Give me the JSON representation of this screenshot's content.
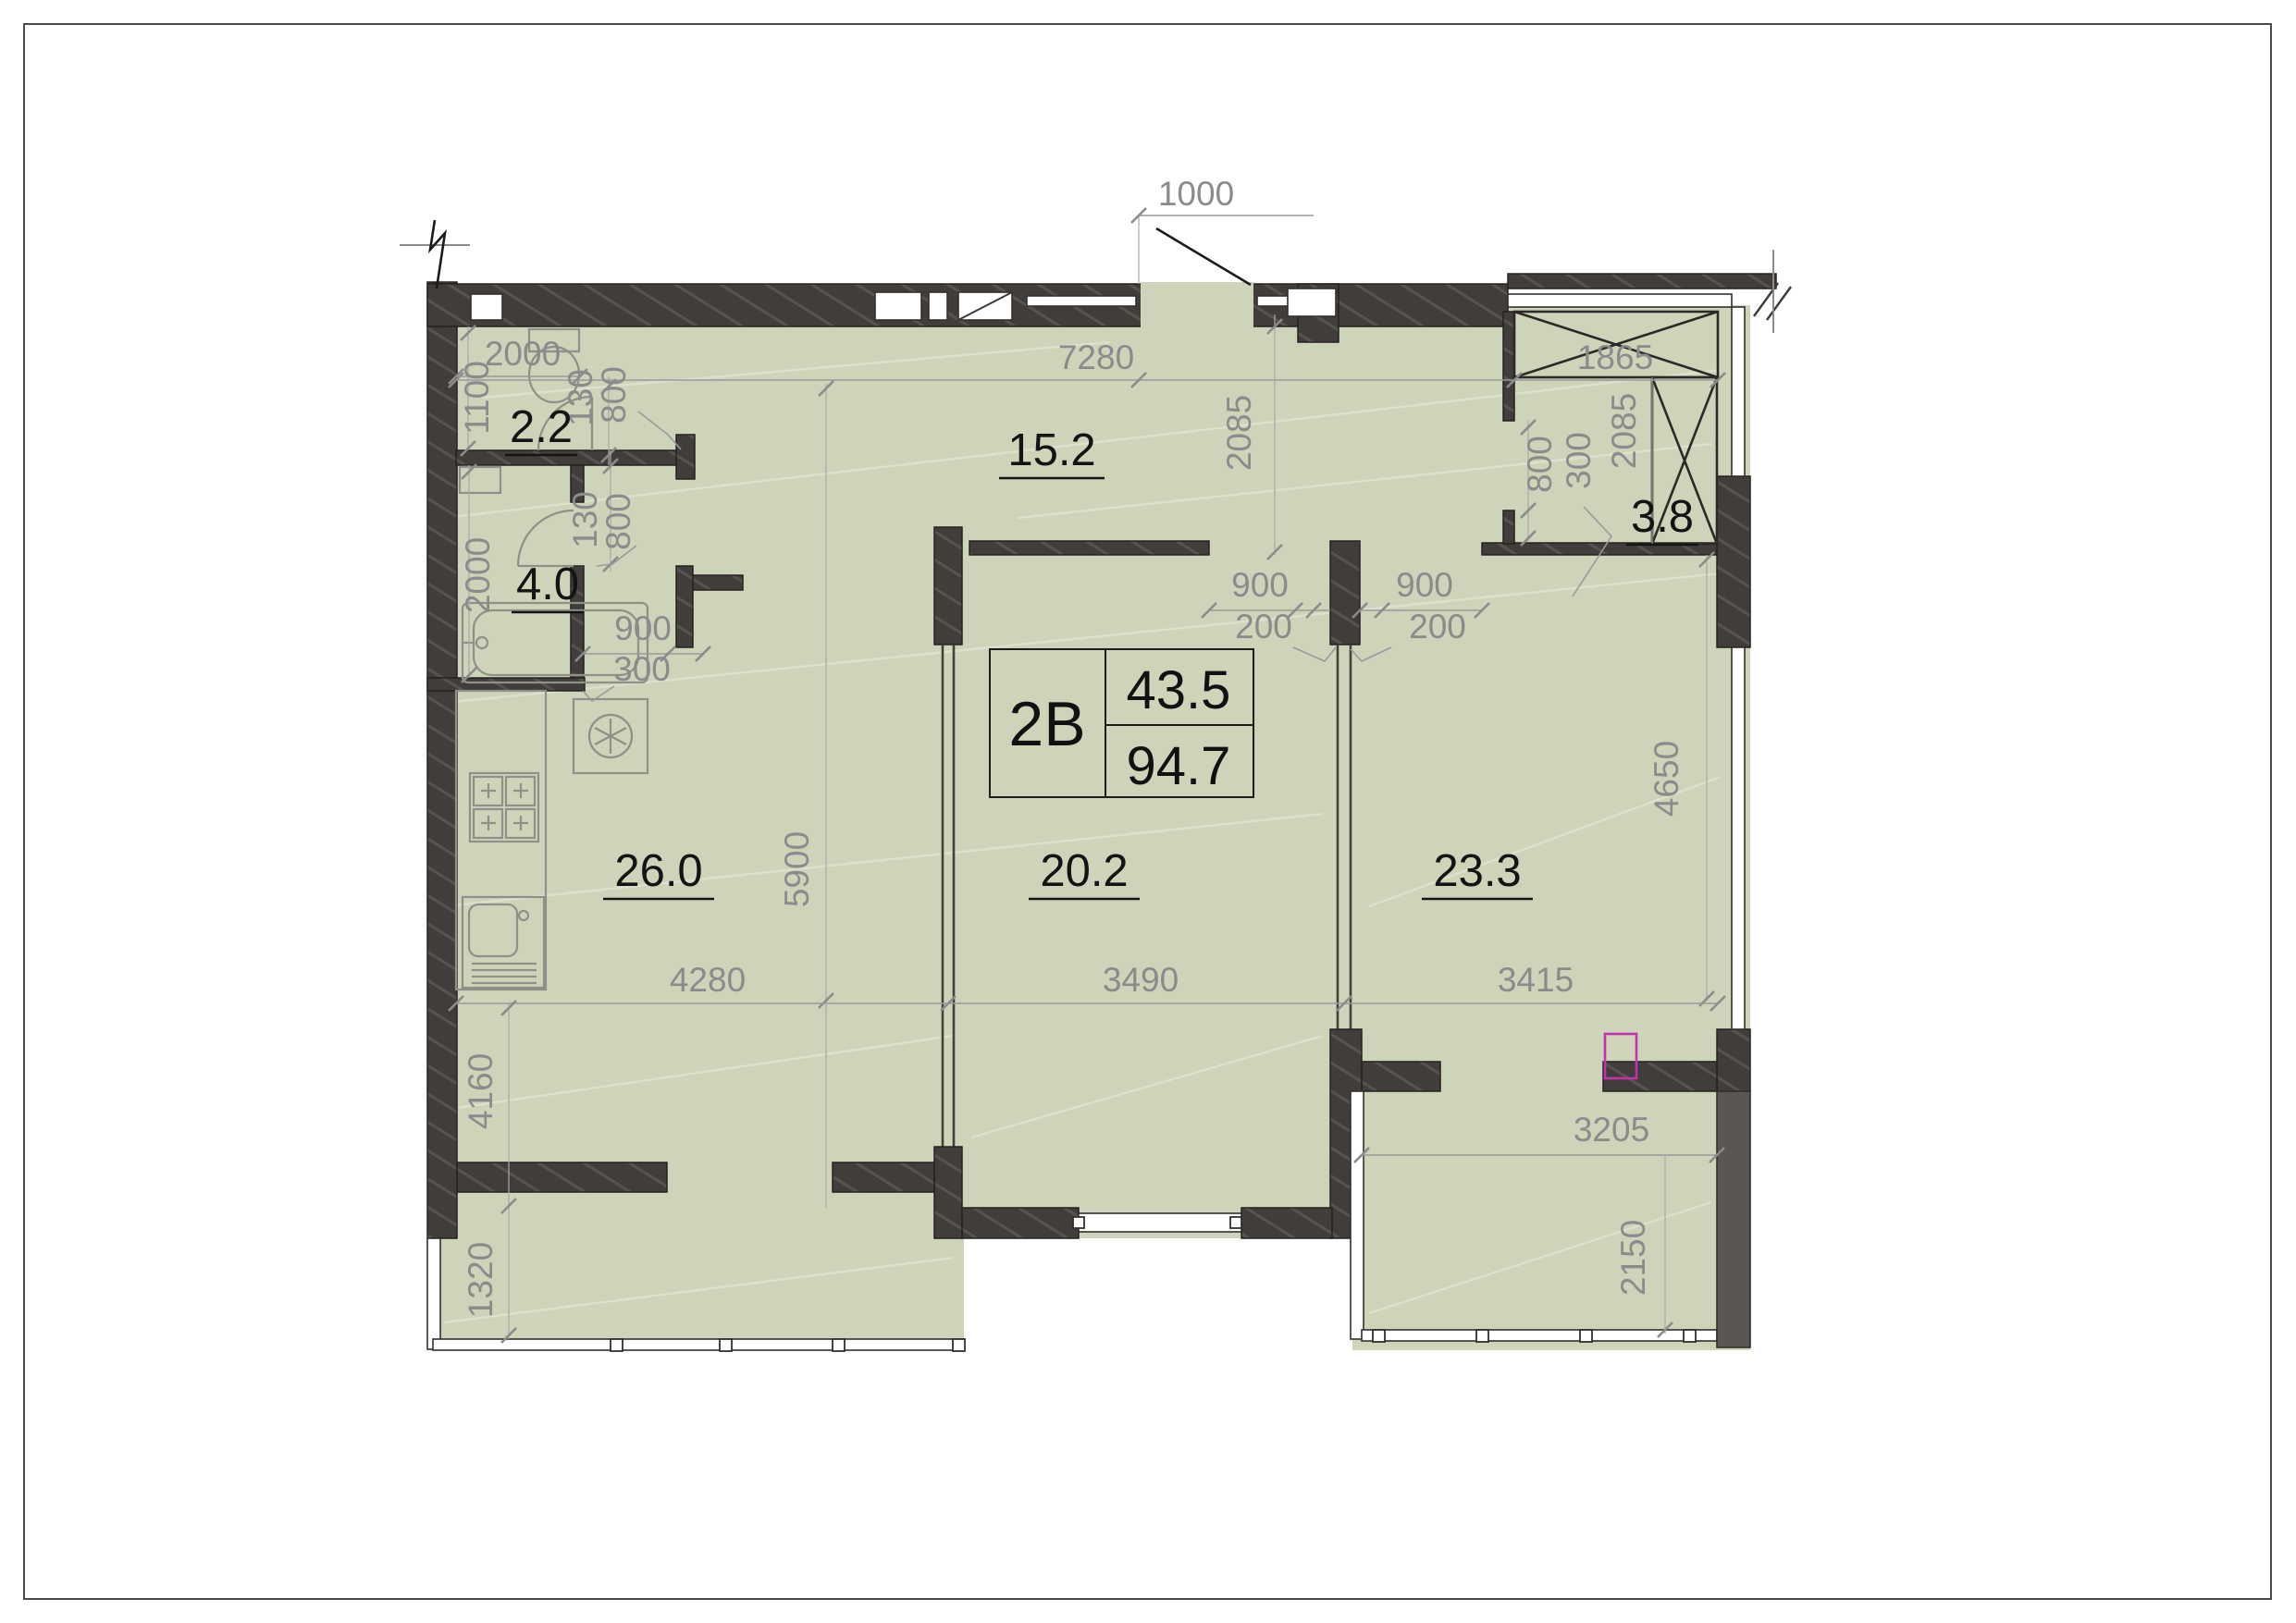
{
  "drawing_type": "apartment-floor-plan",
  "unit": {
    "code": "2B",
    "area_living": "43.5",
    "area_total": "94.7"
  },
  "rooms": [
    {
      "name": "wc",
      "area": "2.2"
    },
    {
      "name": "bathroom",
      "area": "4.0"
    },
    {
      "name": "hallway",
      "area": "15.2"
    },
    {
      "name": "wardrobe",
      "area": "3.8"
    },
    {
      "name": "kitchen-living",
      "area": "26.0"
    },
    {
      "name": "bedroom-middle",
      "area": "20.2"
    },
    {
      "name": "bedroom-right",
      "area": "23.3"
    }
  ],
  "dims": {
    "d1000": "1000",
    "d7280": "7280",
    "d1865": "1865",
    "d2085_hall": "2085",
    "d2085_wardrobe": "2085",
    "d2000_wc": "2000",
    "d1100": "1100",
    "d130_top": "130",
    "d800_top": "800",
    "d130_mid": "130",
    "d800_mid": "800",
    "d2000_bath": "2000",
    "d900_bath": "900",
    "d300_bath": "300",
    "d900_left": "900",
    "d200_left": "200",
    "d900_right": "900",
    "d200_right": "200",
    "d800_wardrobe": "800",
    "d300_wardrobe": "300",
    "d5900": "5900",
    "d4650": "4650",
    "d4280": "4280",
    "d3490": "3490",
    "d3415": "3415",
    "d4160": "4160",
    "d1320": "1320",
    "d3205": "3205",
    "d2150": "2150"
  },
  "colors": {
    "room_fill": "#cdd4b9",
    "wall_dark": "#413d3a",
    "dim_gray": "#8b8b8b",
    "label_black": "#141414",
    "parapet_gray": "#5b5651",
    "accent_magenta": "#c62fae",
    "page_bg": "#ffffff"
  }
}
